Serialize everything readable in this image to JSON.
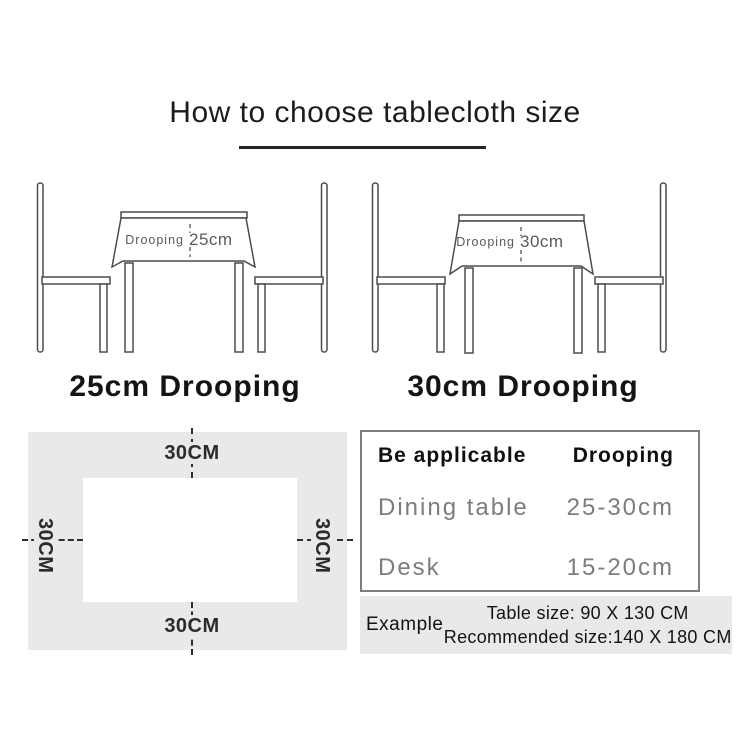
{
  "title": {
    "text": "How to choose tablecloth size"
  },
  "illustrations": [
    {
      "label": "Drooping",
      "value": "25cm",
      "caption": "25cm Drooping"
    },
    {
      "label": "Drooping",
      "value": "30cm",
      "caption": "30cm Drooping"
    }
  ],
  "size_diagram": {
    "top_label": "30CM",
    "bottom_label": "30CM",
    "left_label": "30CM",
    "right_label": "30CM"
  },
  "spec_table": {
    "col1_header": "Be applicable",
    "col2_header": "Drooping",
    "rows": [
      {
        "name": "Dining table",
        "value": "25-30cm"
      },
      {
        "name": "Desk",
        "value": "15-20cm"
      }
    ]
  },
  "example": {
    "label": "Example",
    "table_size_line": "Table size:  90 X 130 CM",
    "recommended_line": "Recommended size:140 X 180 CM"
  },
  "colors": {
    "line_art": "#4c4c4c",
    "gray_panel": "#e9e9e9",
    "muted_text": "#7d7d7d",
    "ink": "#1a1a1a"
  }
}
